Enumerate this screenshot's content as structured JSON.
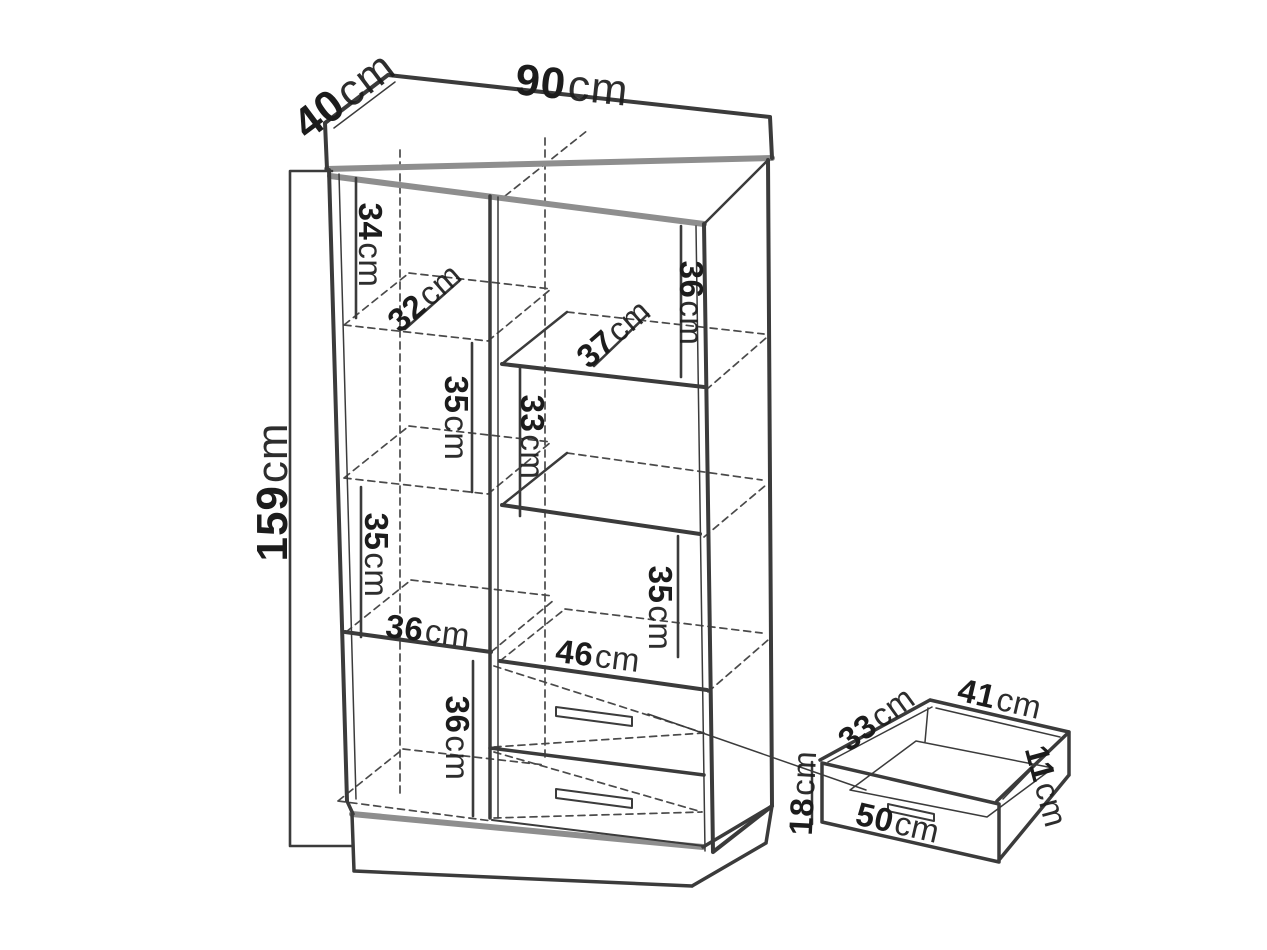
{
  "colors": {
    "line": "#3b3b3b",
    "thick_edge": "#8e8e8e",
    "dash": "#4a4a4a",
    "background": "#ffffff"
  },
  "cabinet": {
    "width": {
      "v": "90",
      "u": "cm"
    },
    "depth": {
      "v": "40",
      "u": "cm"
    },
    "height": {
      "v": "159",
      "u": "cm"
    },
    "left_column": {
      "top_height": {
        "v": "34",
        "u": "cm"
      },
      "top_depth": {
        "v": "32",
        "u": "cm"
      },
      "second_height": {
        "v": "35",
        "u": "cm"
      },
      "third_height": {
        "v": "35",
        "u": "cm"
      },
      "width": {
        "v": "36",
        "u": "cm"
      },
      "bottom_height": {
        "v": "36",
        "u": "cm"
      }
    },
    "right_column": {
      "top_height": {
        "v": "36",
        "u": "cm"
      },
      "top_depth": {
        "v": "37",
        "u": "cm"
      },
      "second_height": {
        "v": "33",
        "u": "cm"
      },
      "third_height": {
        "v": "35",
        "u": "cm"
      },
      "width": {
        "v": "46",
        "u": "cm"
      }
    }
  },
  "drawer_detail": {
    "depth": {
      "v": "33",
      "u": "cm"
    },
    "width": {
      "v": "41",
      "u": "cm"
    },
    "side_height": {
      "v": "11",
      "u": "cm"
    },
    "front_height": {
      "v": "18",
      "u": "cm"
    },
    "front_width": {
      "v": "50",
      "u": "cm"
    }
  }
}
